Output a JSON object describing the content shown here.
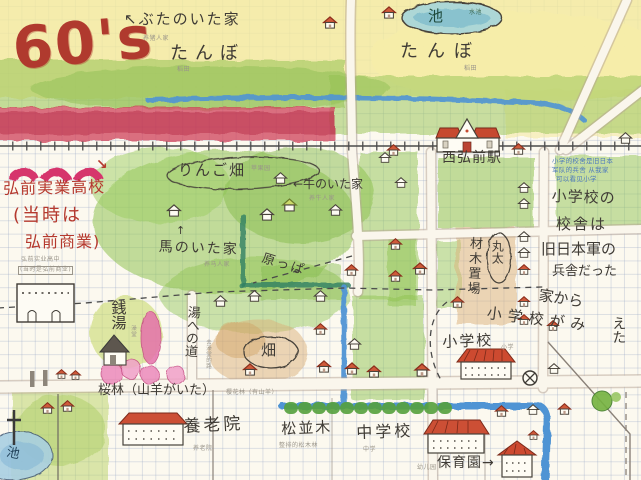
{
  "palette": {
    "title_red": "#b03a2e",
    "handwriting_black": "#3f3b35",
    "note_gray": "#9a958a",
    "note_blue": "#4d79bd",
    "river_blue": "#4f94d4",
    "field_green": "#8fc353",
    "band_red": "#cf4059",
    "cherry_pink": "#eb8abb",
    "roof_red": "#cc4f35"
  },
  "title": "60's",
  "north": {
    "pig_house": {
      "label": "↖ぶたのいた家",
      "note": "养猪人家"
    },
    "tanbo_left": {
      "label": "たんぼ",
      "note": "稻田"
    },
    "tanbo_right": {
      "label": "たんぼ",
      "note": "稻田"
    },
    "pond": {
      "label": "池",
      "note": "水池"
    }
  },
  "station": {
    "label": "西弘前駅"
  },
  "school_note": {
    "cn1": "小学的校舍是旧日本",
    "cn2": "军队的兵舎 从我家",
    "cn3": "可以看见小学",
    "jp1": "小学校の",
    "jp2": "校舎は",
    "jp3": "旧日本軍の",
    "jp4": "兵舎だった",
    "jp5": "家から",
    "jp6": "小学校がみ",
    "jp7": "えた"
  },
  "high_school": {
    "arrow": "↘",
    "line1": "弘前実業高校",
    "line2": "(当時は",
    "line3": "弘前商業)",
    "note1": "弘前实业高中",
    "note2": "(当时是弘前商业)"
  },
  "mid": {
    "apple_orchard": {
      "label": "りんご畑",
      "note": "苹果园"
    },
    "cow_house": {
      "label": "←牛のいた家",
      "note": "养牛人家"
    },
    "horse_house": {
      "arrow": "↑",
      "label": "馬のいた家",
      "note": "养马人家"
    },
    "harappa": {
      "label": "原っぱ"
    },
    "hatake": {
      "label": "畑"
    },
    "lumber": {
      "maruta": "丸太",
      "yard": "材木置場"
    },
    "elementary": {
      "label": "小学校",
      "note": "小学"
    }
  },
  "south": {
    "sento": {
      "label": "銭湯",
      "note": "澡堂"
    },
    "bath_road": {
      "label": "湯への道",
      "note": "去澡堂的路"
    },
    "sakura": {
      "label": "桜林（山羊がいた）",
      "note": "樱花林（有山羊）"
    },
    "nursing_home": {
      "label": "養老院",
      "note": "养老院"
    },
    "pines": {
      "label": "松並木",
      "note": "整排的松木林"
    },
    "junior_high": {
      "label": "中学校",
      "note": "中学"
    },
    "nursery": {
      "label": "保育園→",
      "note": "幼儿园"
    },
    "pond": {
      "label": "池"
    }
  }
}
